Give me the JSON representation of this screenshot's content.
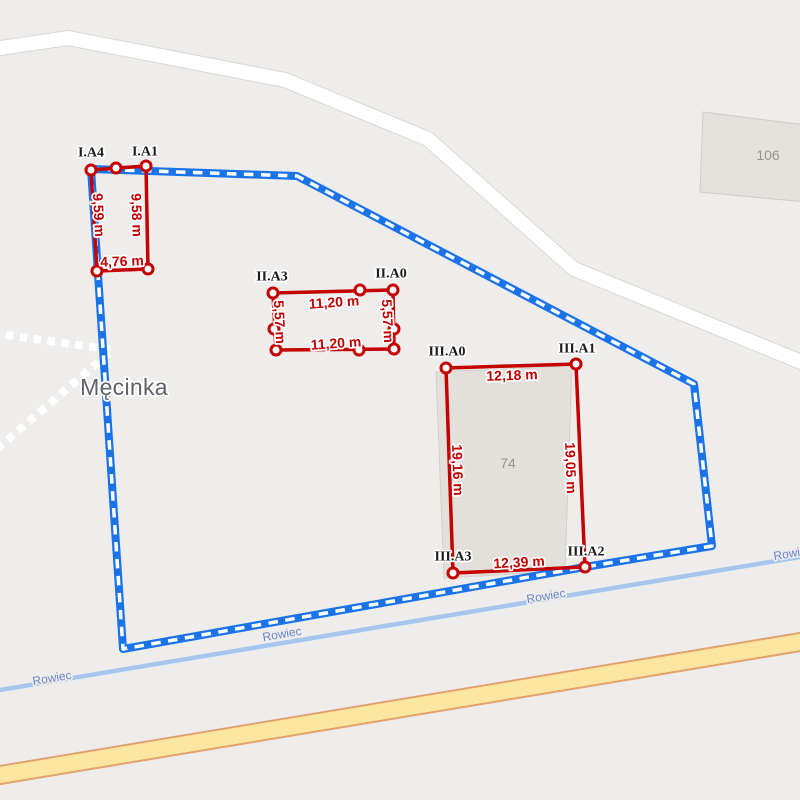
{
  "colors": {
    "background": "#eeedeb",
    "boundary_blue": "#1a73e8",
    "boundary_dash_white": "#ffffff",
    "measure_red": "#c40000",
    "vertex_label_black": "#1b1b1b",
    "stream_blue": "#a6c6ee",
    "stream_label_blue": "#6d87c8",
    "road_yellow_fill": "#fde7a0",
    "road_yellow_casing": "#e2a36e",
    "road_white_fill": "#ffffff",
    "road_white_casing": "#d9d7d4",
    "parcel_fill": "#e5e2de",
    "parcel_border": "#cfccc7",
    "parcel_label_gray": "#9b958d",
    "place_label_gray": "#5e6267",
    "footpath_white": "#ffffff"
  },
  "map": {
    "place_label": "Męcinka",
    "stream_labels": [
      "Rowiec",
      "Rowiec",
      "Rowiec",
      "Rowiec"
    ],
    "parcel_106_label": "106",
    "parcel_74_label": "74"
  },
  "measurements": {
    "group_I": {
      "vertices": [
        "I.A4",
        "I.A1"
      ],
      "sides": {
        "left": "9,59 m",
        "right": "9,58 m",
        "bottom": "4,76 m"
      }
    },
    "group_II": {
      "vertices": [
        "II.A3",
        "II.A0"
      ],
      "sides": {
        "top": "11,20 m",
        "bottom": "11,20 m",
        "left": "5,57 m",
        "right": "5,57 m"
      }
    },
    "group_III": {
      "vertices": [
        "III.A0",
        "III.A1",
        "III.A3",
        "III.A2"
      ],
      "sides": {
        "top": "12,18 m",
        "bottom": "12,39 m",
        "left": "19,16 m",
        "right": "19,05 m"
      }
    }
  }
}
